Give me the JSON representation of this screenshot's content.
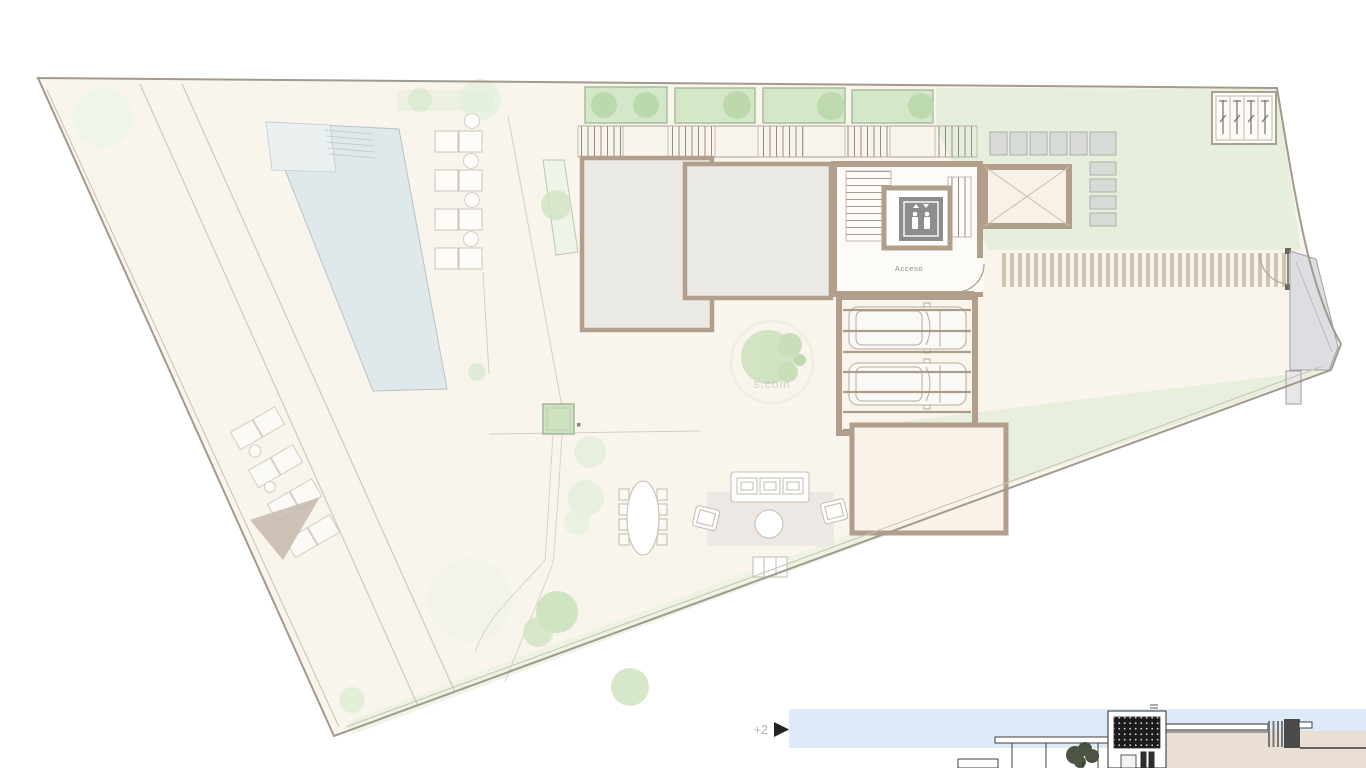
{
  "document": {
    "type": "architectural-site-plan",
    "floor": "roof-terrace plan with garden, pool and access level"
  },
  "plan": {
    "access_label": "Acceso",
    "watermark": "s.com"
  },
  "elevation": {
    "level_label": "+2",
    "arrow_icon": "play-arrow-icon"
  },
  "icons": {
    "elevator": "elevator-icon",
    "level_arrow": "play-arrow-icon"
  },
  "colors": {
    "page_bg": "#ffffff",
    "site_fill": "#faf5ec",
    "boundary": "#a29a8e",
    "pool_water": "#dfe9eb",
    "pool_shallow": "#ebf0f1",
    "lawn": "#e5efdb",
    "planter_green": "#d5e7c9",
    "tree_green": "#b9d8ab",
    "roof_fill": "#ebe9e5",
    "wall_tan": "#b19f8b",
    "panel_gray": "#d8dad6",
    "elevator_gray": "#8d8d8d",
    "sky_blue": "#dcebf7",
    "rug": "#ece7e3",
    "drive_stripe": "#cfc3b2",
    "entry_gray": "#dedee2",
    "shade_sail": "#c5b9ae",
    "ground_beige": "#eadfd4",
    "elevation_line": "#2e2e2e"
  }
}
